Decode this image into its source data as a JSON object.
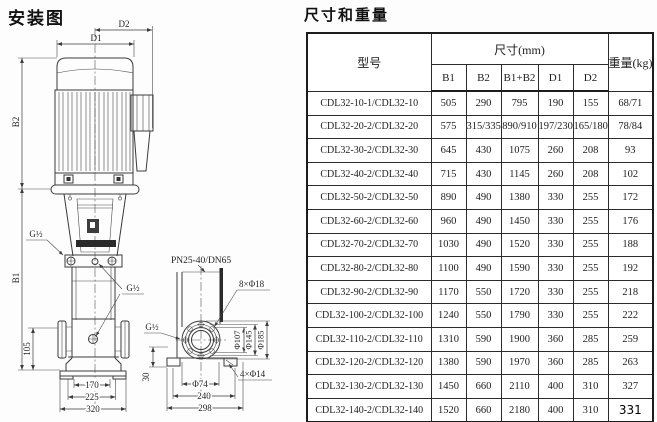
{
  "colors": {
    "ink": "#1d1d1d",
    "paper": "#fdfdfd"
  },
  "titles": {
    "diagram": "安装图",
    "table": "尺寸和重量"
  },
  "diagram": {
    "front": {
      "d2": "D2",
      "d1": "D1",
      "b2": "B2",
      "b1": "B1",
      "g_left": "G½",
      "g_right": "G½",
      "dim105": "105",
      "dim170": "170",
      "dim225": "225",
      "dim320": "320"
    },
    "top": {
      "flange": "PN25-40/DN65",
      "bolts8": "8×Φ18",
      "g": "G½",
      "d107": "Φ107",
      "d145": "Φ145",
      "d185": "Φ185",
      "dim30": "30",
      "d74": "Φ74",
      "dim240": "240",
      "dim298": "298",
      "bolts4": "4×Φ14"
    }
  },
  "table": {
    "header": {
      "model": "型号",
      "size_group": "尺寸(mm)",
      "size_cols": [
        "B1",
        "B2",
        "B1+B2",
        "D1",
        "D2"
      ],
      "weight": "重量(kg)"
    },
    "rows": [
      {
        "model": "CDL32-10-1/CDL32-10",
        "values": [
          "505",
          "290",
          "795",
          "190",
          "155",
          "68/71"
        ]
      },
      {
        "model": "CDL32-20-2/CDL32-20",
        "values": [
          "575",
          "315/335",
          "890/910",
          "197/230",
          "165/180",
          "78/84"
        ]
      },
      {
        "model": "CDL32-30-2/CDL32-30",
        "values": [
          "645",
          "430",
          "1075",
          "260",
          "208",
          "93"
        ]
      },
      {
        "model": "CDL32-40-2/CDL32-40",
        "values": [
          "715",
          "430",
          "1145",
          "260",
          "208",
          "102"
        ]
      },
      {
        "model": "CDL32-50-2/CDL32-50",
        "values": [
          "890",
          "490",
          "1380",
          "330",
          "255",
          "172"
        ]
      },
      {
        "model": "CDL32-60-2/CDL32-60",
        "values": [
          "960",
          "490",
          "1450",
          "330",
          "255",
          "176"
        ]
      },
      {
        "model": "CDL32-70-2/CDL32-70",
        "values": [
          "1030",
          "490",
          "1520",
          "330",
          "255",
          "188"
        ]
      },
      {
        "model": "CDL32-80-2/CDL32-80",
        "values": [
          "1100",
          "490",
          "1590",
          "330",
          "255",
          "192"
        ]
      },
      {
        "model": "CDL32-90-2/CDL32-90",
        "values": [
          "1170",
          "550",
          "1720",
          "330",
          "255",
          "218"
        ]
      },
      {
        "model": "CDL32-100-2/CDL32-100",
        "values": [
          "1240",
          "550",
          "1790",
          "330",
          "255",
          "222"
        ]
      },
      {
        "model": "CDL32-110-2/CDL32-110",
        "values": [
          "1310",
          "590",
          "1900",
          "360",
          "285",
          "259"
        ]
      },
      {
        "model": "CDL32-120-2/CDL32-120",
        "values": [
          "1380",
          "590",
          "1970",
          "360",
          "285",
          "263"
        ]
      },
      {
        "model": "CDL32-130-2/CDL32-130",
        "values": [
          "1450",
          "660",
          "2110",
          "400",
          "310",
          "327"
        ]
      },
      {
        "model": "CDL32-140-2/CDL32-140",
        "values": [
          "1520",
          "660",
          "2180",
          "400",
          "310",
          "331"
        ]
      }
    ]
  }
}
